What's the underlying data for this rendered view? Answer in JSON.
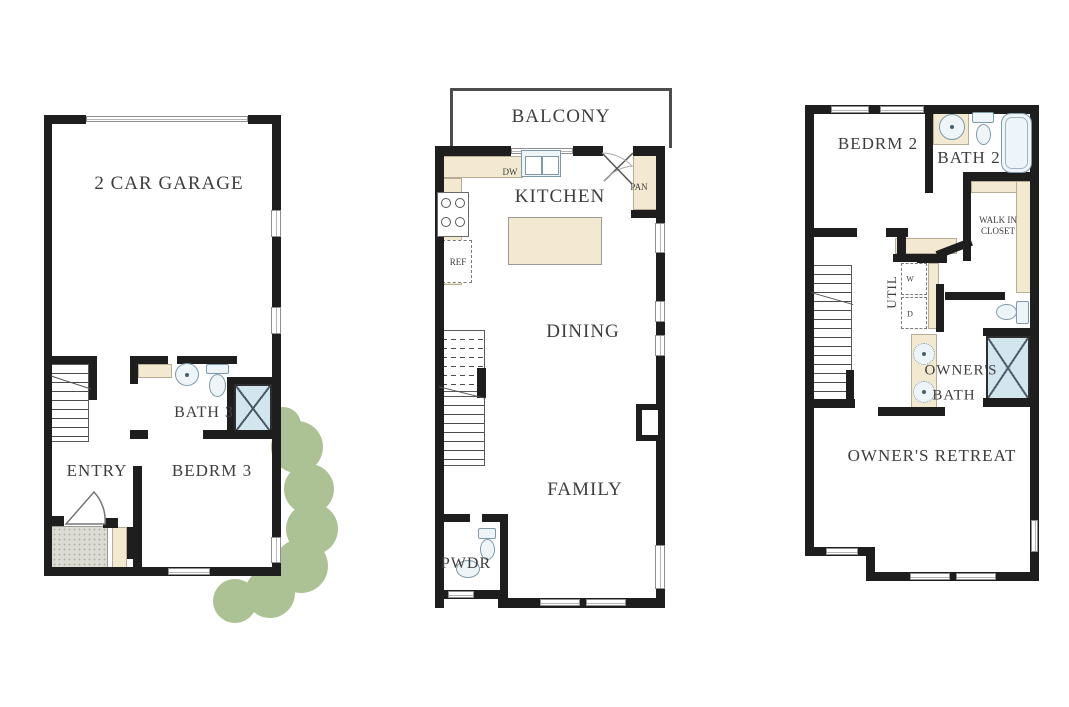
{
  "title": "Three-story townhome floor plan",
  "colors": {
    "wall": "#1e1e1e",
    "counter": "#f3e9d1",
    "fixture_fill": "#eef5f9",
    "fixture_line": "#7e99a9",
    "shower": "#d3e5ee",
    "bush": "#adc294",
    "porch": "#dcdcd4",
    "text": "#3d3d3d"
  },
  "floor1": {
    "garage": "2 CAR GARAGE",
    "bath": "BATH 3",
    "entry": "ENTRY",
    "bedroom": "BEDRM 3"
  },
  "floor2": {
    "balcony": "BALCONY",
    "kitchen": "KITCHEN",
    "dishwasher": "DW",
    "pantry": "PAN",
    "refrigerator": "REF",
    "dining": "DINING",
    "family": "FAMILY",
    "powder": "PWDR"
  },
  "floor3": {
    "bedroom": "BEDRM 2",
    "bath": "BATH 2",
    "walk_in_closet_line1": "WALK IN",
    "walk_in_closet_line2": "CLOSET",
    "utility": "UTIL",
    "washer": "W",
    "dryer": "D",
    "owners_bath_line1": "OWNER'S",
    "owners_bath_line2": "BATH",
    "owners_retreat": "OWNER'S RETREAT"
  }
}
